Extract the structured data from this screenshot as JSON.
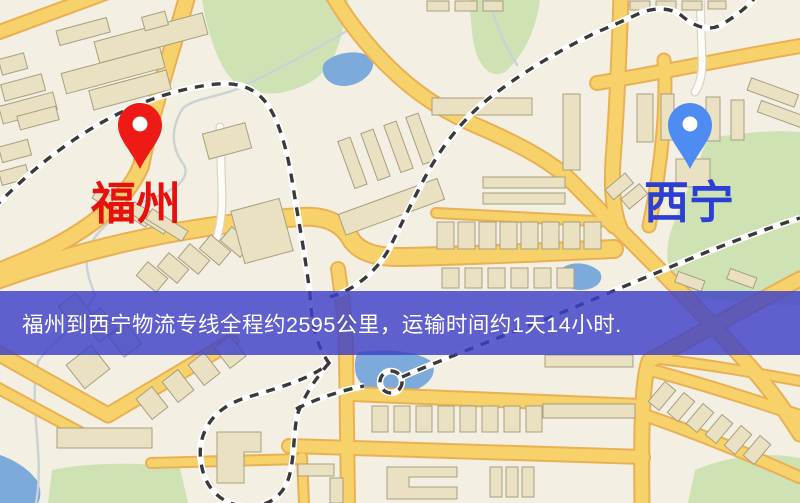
{
  "page": {
    "width": 800,
    "height": 503,
    "kind": "logistics-route-map"
  },
  "map": {
    "origin": {
      "label": "福州"
    },
    "destination": {
      "label": "西宁"
    }
  },
  "banner": {
    "text": "福州到西宁物流专线全程约2595公里，运输时间约1天14小时."
  },
  "colors": {
    "map_bg": "#f3efe2",
    "green": "#cfe2b4",
    "water": "#7cabdb",
    "stream": "#c9d2d4",
    "road_fill": "#f7d169",
    "road_casing": "#eab054",
    "road_white": "#fcfcf8",
    "road_white_casing": "#dbd4c4",
    "building_fill": "#eae1c3",
    "building_stroke": "#a89f80",
    "rail_dash": "#3a3a3a",
    "rail_casing": "#ffffff",
    "banner_bg": "rgba(62,64,200,0.82)",
    "banner_text": "#ffffff",
    "origin_label_color": "#e8100c",
    "dest_label_color": "#2b3fd4",
    "origin_pin_color": "#ee1a15",
    "dest_pin_color": "#4f8cf2"
  }
}
